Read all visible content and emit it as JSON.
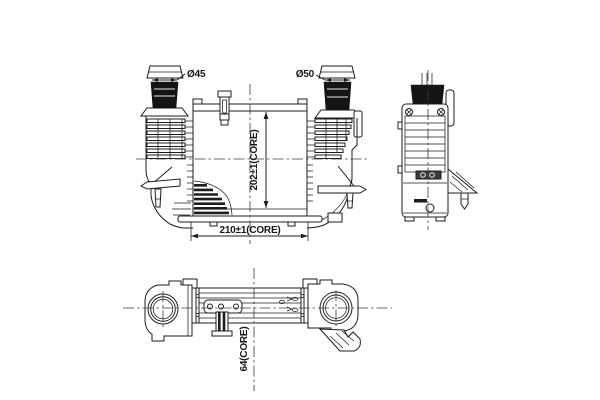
{
  "drawing": {
    "background_color": "#ffffff",
    "line_color": "#1d1d1d",
    "front_view": {
      "labels": {
        "left_port_diameter": "Ø45",
        "right_port_diameter": "Ø50",
        "core_height": "202±1(CORE)",
        "core_width": "210±1(CORE)"
      }
    },
    "bottom_view": {
      "labels": {
        "core_depth": "64(CORE)"
      }
    }
  }
}
